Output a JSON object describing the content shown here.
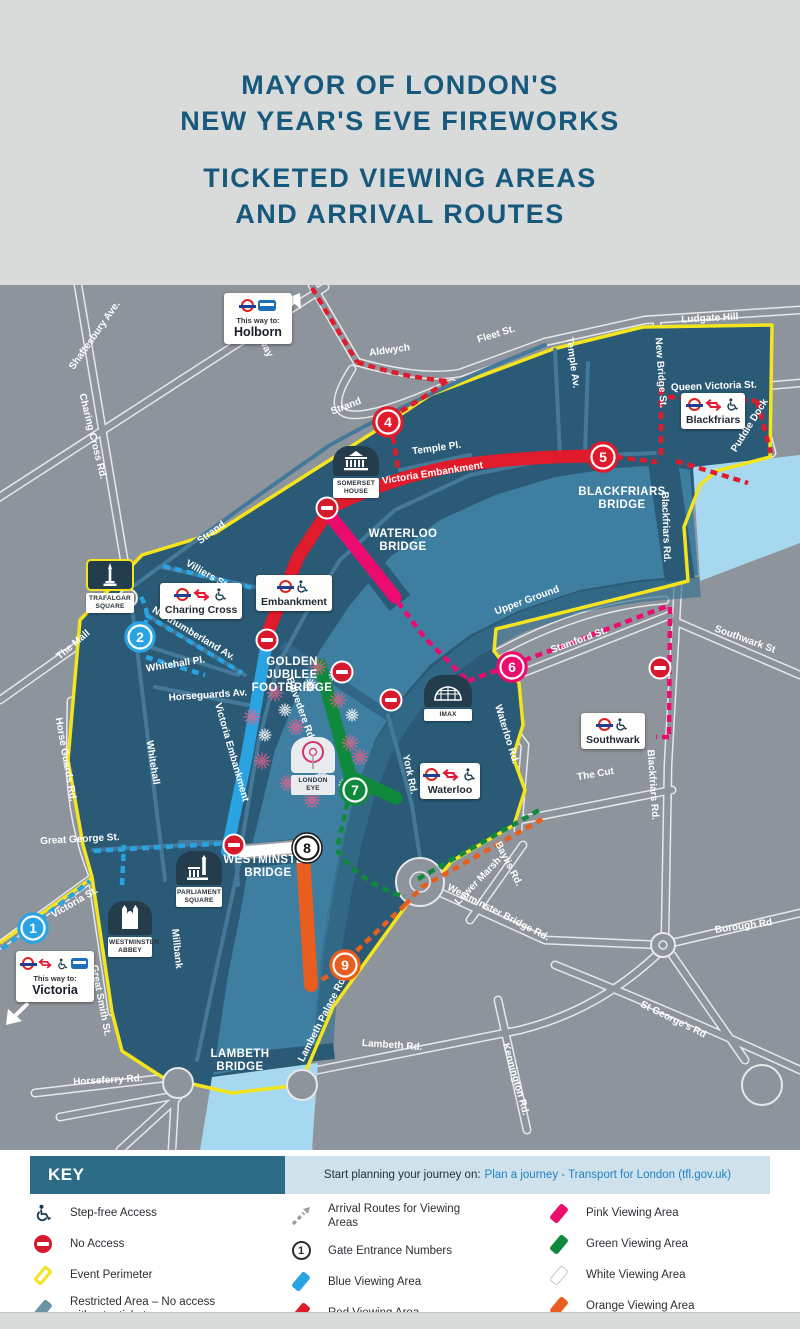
{
  "header": {
    "title_line1": "MAYOR OF LONDON'S",
    "title_line2": "NEW YEAR'S EVE FIREWORKS",
    "subtitle_line1": "TICKETED VIEWING AREAS",
    "subtitle_line2": "AND ARRIVAL ROUTES"
  },
  "colors": {
    "accent_teal": "#17597c",
    "map_bg": "#8e949b",
    "land": "#2a5a75",
    "river_in": "#3e7ea1",
    "river_out": "#a6d9ef",
    "yellow": "#f4e41d",
    "red": "#e01b2b",
    "blue": "#29a3e2",
    "pink": "#ec0c70",
    "green": "#0f8a3c",
    "orange": "#e95d1f",
    "white": "#ffffff",
    "slate": "#6b93a8",
    "roundel_red": "#dc241f",
    "roundel_blue": "#1c3f94",
    "link": "#1f83c6"
  },
  "map": {
    "street_labels": [
      {
        "t": "Shaftesbury Ave.",
        "x": 97,
        "y": 52,
        "r": -55
      },
      {
        "t": "Charing Cross Rd.",
        "x": 90,
        "y": 152,
        "r": 76
      },
      {
        "t": "Kingsway",
        "x": 257,
        "y": 52,
        "r": 62
      },
      {
        "t": "Aldwych",
        "x": 390,
        "y": 68,
        "r": -8
      },
      {
        "t": "Fleet St.",
        "x": 497,
        "y": 52,
        "r": -17
      },
      {
        "t": "Ludgate Hill",
        "x": 710,
        "y": 36,
        "r": -3
      },
      {
        "t": "New Bridge St.",
        "x": 658,
        "y": 88,
        "r": 86
      },
      {
        "t": "Queen Victoria St.",
        "x": 714,
        "y": 104,
        "r": -2
      },
      {
        "t": "Puddle Dock",
        "x": 752,
        "y": 142,
        "r": -58
      },
      {
        "t": "Temple Av.",
        "x": 570,
        "y": 78,
        "r": 82
      },
      {
        "t": "Temple Pl.",
        "x": 437,
        "y": 166,
        "r": -8
      },
      {
        "t": "Strand",
        "x": 347,
        "y": 124,
        "r": -21
      },
      {
        "t": "Strand",
        "x": 213,
        "y": 250,
        "r": -36
      },
      {
        "t": "Victoria Embankment",
        "x": 433,
        "y": 191,
        "r": -9
      },
      {
        "t": "Blackfriars Rd.",
        "x": 663,
        "y": 242,
        "r": 88
      },
      {
        "t": "Blackfriars Rd.",
        "x": 650,
        "y": 500,
        "r": 86
      },
      {
        "t": "Southwark St",
        "x": 744,
        "y": 357,
        "r": 20
      },
      {
        "t": "Upper Ground",
        "x": 528,
        "y": 318,
        "r": -20
      },
      {
        "t": "Stamford St.",
        "x": 580,
        "y": 358,
        "r": -20
      },
      {
        "t": "The Cut",
        "x": 596,
        "y": 492,
        "r": -10
      },
      {
        "t": "Waterloo Rd.",
        "x": 504,
        "y": 450,
        "r": 73
      },
      {
        "t": "York Rd.",
        "x": 407,
        "y": 490,
        "r": 78
      },
      {
        "t": "Belvedere Rd.",
        "x": 298,
        "y": 425,
        "r": 70
      },
      {
        "t": "Victoria Embankment",
        "x": 229,
        "y": 468,
        "r": 74
      },
      {
        "t": "Whitehall",
        "x": 150,
        "y": 478,
        "r": 81
      },
      {
        "t": "Horse Guards Rd.",
        "x": 63,
        "y": 475,
        "r": 80
      },
      {
        "t": "The Mall",
        "x": 75,
        "y": 362,
        "r": -40
      },
      {
        "t": "Northumberland Av.",
        "x": 192,
        "y": 351,
        "r": 31
      },
      {
        "t": "Whitehall Pl.",
        "x": 176,
        "y": 382,
        "r": -9
      },
      {
        "t": "Horseguards Av.",
        "x": 208,
        "y": 413,
        "r": -4
      },
      {
        "t": "Villiers St.",
        "x": 206,
        "y": 292,
        "r": 30
      },
      {
        "t": "Great George St.",
        "x": 80,
        "y": 557,
        "r": -3
      },
      {
        "t": "Victoria St.",
        "x": 76,
        "y": 620,
        "r": -30
      },
      {
        "t": "Great Smith St.",
        "x": 98,
        "y": 716,
        "r": 79
      },
      {
        "t": "Horseferry Rd.",
        "x": 108,
        "y": 798,
        "r": -3
      },
      {
        "t": "Millbank",
        "x": 174,
        "y": 664,
        "r": 84
      },
      {
        "t": "Lambeth Palace Rd.",
        "x": 325,
        "y": 735,
        "r": -63
      },
      {
        "t": "Westminster Bridge Rd.",
        "x": 497,
        "y": 630,
        "r": 27
      },
      {
        "t": "Baylis Rd.",
        "x": 506,
        "y": 580,
        "r": 63
      },
      {
        "t": "Lower Marsh",
        "x": 480,
        "y": 598,
        "r": -46
      },
      {
        "t": "Kennington Rd.",
        "x": 513,
        "y": 795,
        "r": 74
      },
      {
        "t": "Lambeth Rd.",
        "x": 392,
        "y": 763,
        "r": 4
      },
      {
        "t": "Borough Rd",
        "x": 744,
        "y": 644,
        "r": -8
      },
      {
        "t": "St George's Rd",
        "x": 672,
        "y": 737,
        "r": 26
      }
    ],
    "bridge_labels": [
      {
        "lines": [
          "WATERLOO",
          "BRIDGE"
        ],
        "x": 403,
        "y": 252
      },
      {
        "lines": [
          "BLACKFRIARS",
          "BRIDGE"
        ],
        "x": 622,
        "y": 210
      },
      {
        "lines": [
          "WESTMINSTER",
          "BRIDGE"
        ],
        "x": 268,
        "y": 578
      },
      {
        "lines": [
          "LAMBETH",
          "BRIDGE"
        ],
        "x": 240,
        "y": 772
      },
      {
        "lines": [
          "GOLDEN",
          "JUBILEE",
          "FOOTBRIDGE"
        ],
        "x": 292,
        "y": 380
      }
    ],
    "gates": [
      {
        "n": "1",
        "c": "blue",
        "x": 33,
        "y": 643
      },
      {
        "n": "2",
        "c": "blue",
        "x": 140,
        "y": 352
      },
      {
        "n": "4",
        "c": "red",
        "x": 388,
        "y": 137
      },
      {
        "n": "5",
        "c": "red",
        "x": 603,
        "y": 172
      },
      {
        "n": "6",
        "c": "pink",
        "x": 512,
        "y": 382
      },
      {
        "n": "7",
        "c": "green",
        "x": 355,
        "y": 505
      },
      {
        "n": "8",
        "c": "white",
        "x": 307,
        "y": 563
      },
      {
        "n": "9",
        "c": "orange",
        "x": 345,
        "y": 680
      }
    ],
    "no_access": [
      {
        "x": 327,
        "y": 223
      },
      {
        "x": 267,
        "y": 355
      },
      {
        "x": 342,
        "y": 387
      },
      {
        "x": 391,
        "y": 415
      },
      {
        "x": 234,
        "y": 560
      },
      {
        "x": 660,
        "y": 383
      }
    ],
    "fireworks": {
      "pink": [
        [
          275,
          408
        ],
        [
          318,
          382
        ],
        [
          262,
          476
        ],
        [
          350,
          458
        ],
        [
          338,
          415
        ],
        [
          288,
          498
        ],
        [
          252,
          432
        ],
        [
          312,
          515
        ],
        [
          360,
          472
        ],
        [
          296,
          442
        ]
      ],
      "white": [
        [
          300,
          462
        ],
        [
          335,
          390
        ],
        [
          265,
          450
        ],
        [
          352,
          430
        ],
        [
          322,
          490
        ],
        [
          285,
          425
        ],
        [
          345,
          500
        ],
        [
          310,
          400
        ]
      ]
    },
    "stations": [
      {
        "name": "Charing Cross"
      },
      {
        "name": "Embankment"
      },
      {
        "name": "Blackfriars"
      },
      {
        "name": "Southwark"
      },
      {
        "name": "Waterloo"
      }
    ],
    "landmarks": [
      {
        "label": "TRAFALGAR SQUARE"
      },
      {
        "label": "SOMERSET HOUSE"
      },
      {
        "label": "LONDON EYE"
      },
      {
        "label": "IMAX"
      },
      {
        "label": "PARLIAMENT SQUARE"
      },
      {
        "label": "WESTMINSTER ABBEY"
      }
    ],
    "signs": [
      {
        "prefix": "This way to:",
        "name": "Holborn"
      },
      {
        "prefix": "This way to:",
        "name": "Victoria"
      }
    ]
  },
  "key": {
    "title": "KEY",
    "journey_prefix": "Start planning your journey on:",
    "journey_link": "Plan a journey - Transport for London (tfl.gov.uk)",
    "columns": [
      [
        {
          "icon": "step-free",
          "label": "Step-free Access"
        },
        {
          "icon": "no-access",
          "label": "No Access"
        },
        {
          "icon": "event-perimeter",
          "label": "Event Perimeter"
        },
        {
          "icon": "restricted",
          "label": "Restricted Area – No access without a ticket"
        }
      ],
      [
        {
          "icon": "arrival",
          "label": "Arrival Routes for Viewing Areas"
        },
        {
          "icon": "gate",
          "icon_text": "1",
          "label": "Gate Entrance Numbers"
        },
        {
          "icon": "area-blue",
          "label": "Blue Viewing Area"
        },
        {
          "icon": "area-red",
          "label": "Red Viewing Area"
        }
      ],
      [
        {
          "icon": "area-pink",
          "label": "Pink Viewing Area"
        },
        {
          "icon": "area-green",
          "label": "Green Viewing Area"
        },
        {
          "icon": "area-white",
          "label": "White Viewing Area"
        },
        {
          "icon": "area-orange",
          "label": "Orange Viewing Area"
        }
      ]
    ]
  }
}
